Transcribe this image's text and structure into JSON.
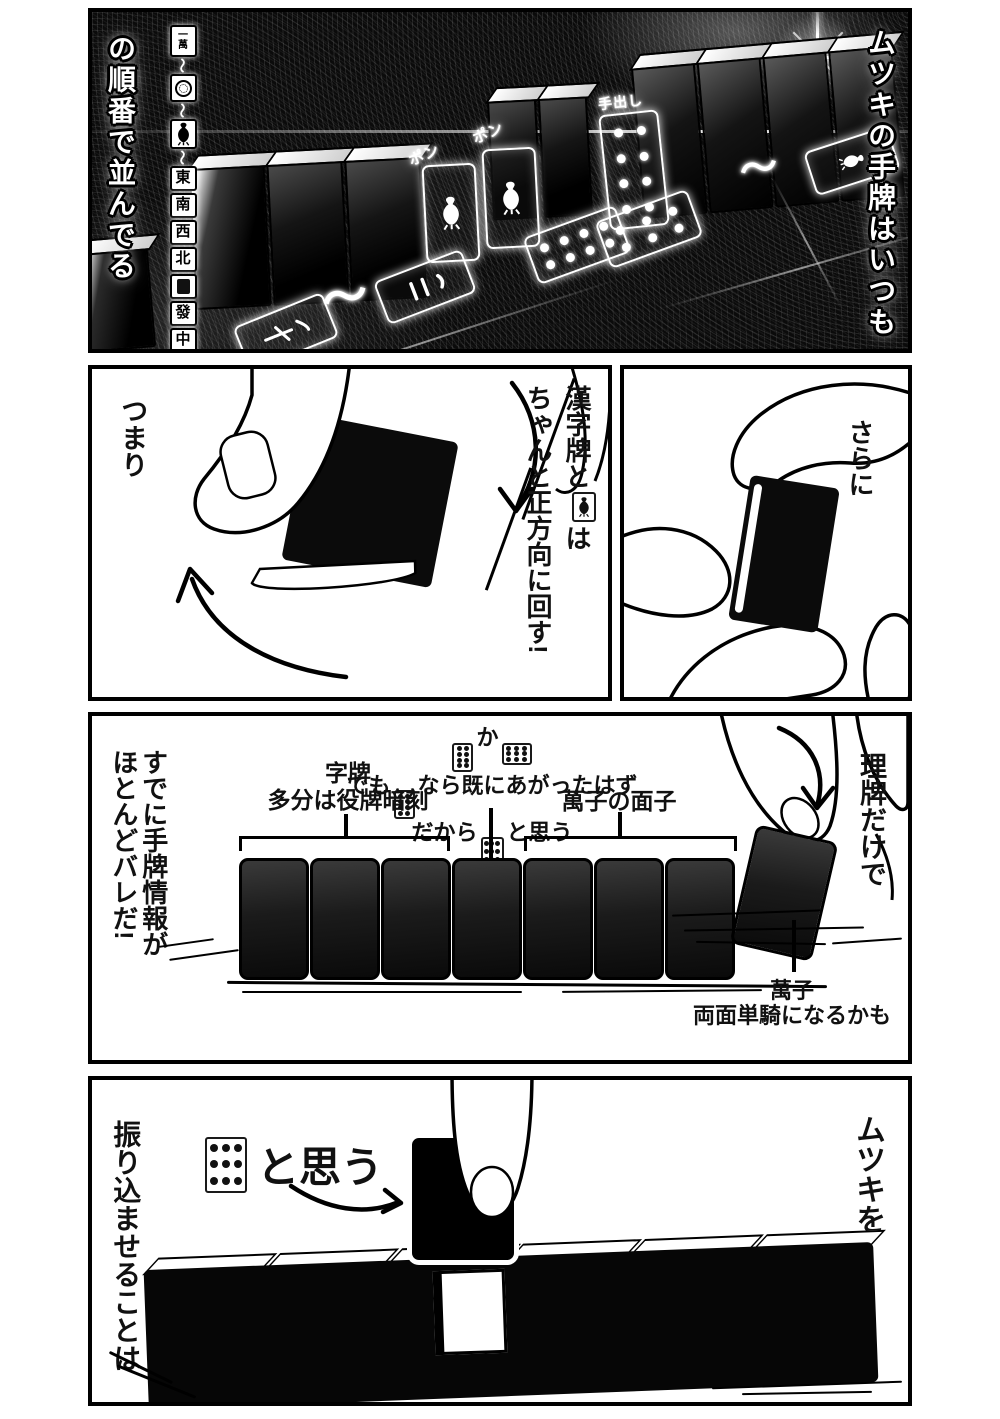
{
  "page": {
    "bg": "#ffffff",
    "ink": "#000000",
    "panel1_bg": "#0b0b0b"
  },
  "panel1": {
    "caption_right": "ムツキの手牌はいつも",
    "caption_left": "の順番で並んでる",
    "tilde_mark": "〜",
    "pon_label_1": "ポン",
    "pon_label_2": "ポン",
    "tedashi_label": "手出し",
    "tile_order": [
      {
        "kind": "tile-man1",
        "text": "一萬"
      },
      {
        "kind": "tilde",
        "text": "〜"
      },
      {
        "kind": "tile-pin1"
      },
      {
        "kind": "tilde",
        "text": "〜"
      },
      {
        "kind": "tile-sou1"
      },
      {
        "kind": "tilde",
        "text": "〜"
      },
      {
        "kind": "tile-text",
        "text": "東"
      },
      {
        "kind": "tile-text",
        "text": "南"
      },
      {
        "kind": "tile-text",
        "text": "西"
      },
      {
        "kind": "tile-text",
        "text": "北"
      },
      {
        "kind": "tile-haku"
      },
      {
        "kind": "tile-text",
        "text": "發"
      },
      {
        "kind": "tile-text",
        "text": "中"
      }
    ]
  },
  "panel2_left": {
    "caption": "つまり",
    "note_lines": [
      [
        {
          "text": "漢字牌と"
        },
        {
          "icon": "sou1"
        },
        {
          "text": "は"
        }
      ],
      [
        {
          "text": "ちゃんと正方向に回す!"
        }
      ]
    ]
  },
  "panel2_right": {
    "caption": "さらに"
  },
  "panel3": {
    "caption_left_lines": [
      "すでに手牌情報が",
      "ほとんどバレだ!"
    ],
    "caption_right": "理牌だけで",
    "label_jihai_lines": [
      "字牌",
      "多分は役牌暗刻"
    ],
    "guess_lines": [
      [
        {
          "icon": "pin8"
        },
        {
          "text": "か"
        },
        {
          "icon": "pin9h"
        }
      ],
      [
        {
          "text": "でも"
        },
        {
          "icon": "pin8"
        },
        {
          "text": "なら既にあがったはず"
        }
      ],
      [
        {
          "text": "だから"
        },
        {
          "icon": "pin9"
        },
        {
          "text": "と思う"
        }
      ]
    ],
    "label_manzu": "萬子の面子",
    "label_tanki_lines": [
      "萬子",
      "両面単騎になるかも"
    ],
    "hand_tile_count": 7
  },
  "panel4": {
    "caption_right": "ムツキを",
    "caption_left": "振り込ませることは",
    "thought": [
      {
        "icon": "pin9"
      },
      {
        "text": "と思う"
      }
    ]
  }
}
